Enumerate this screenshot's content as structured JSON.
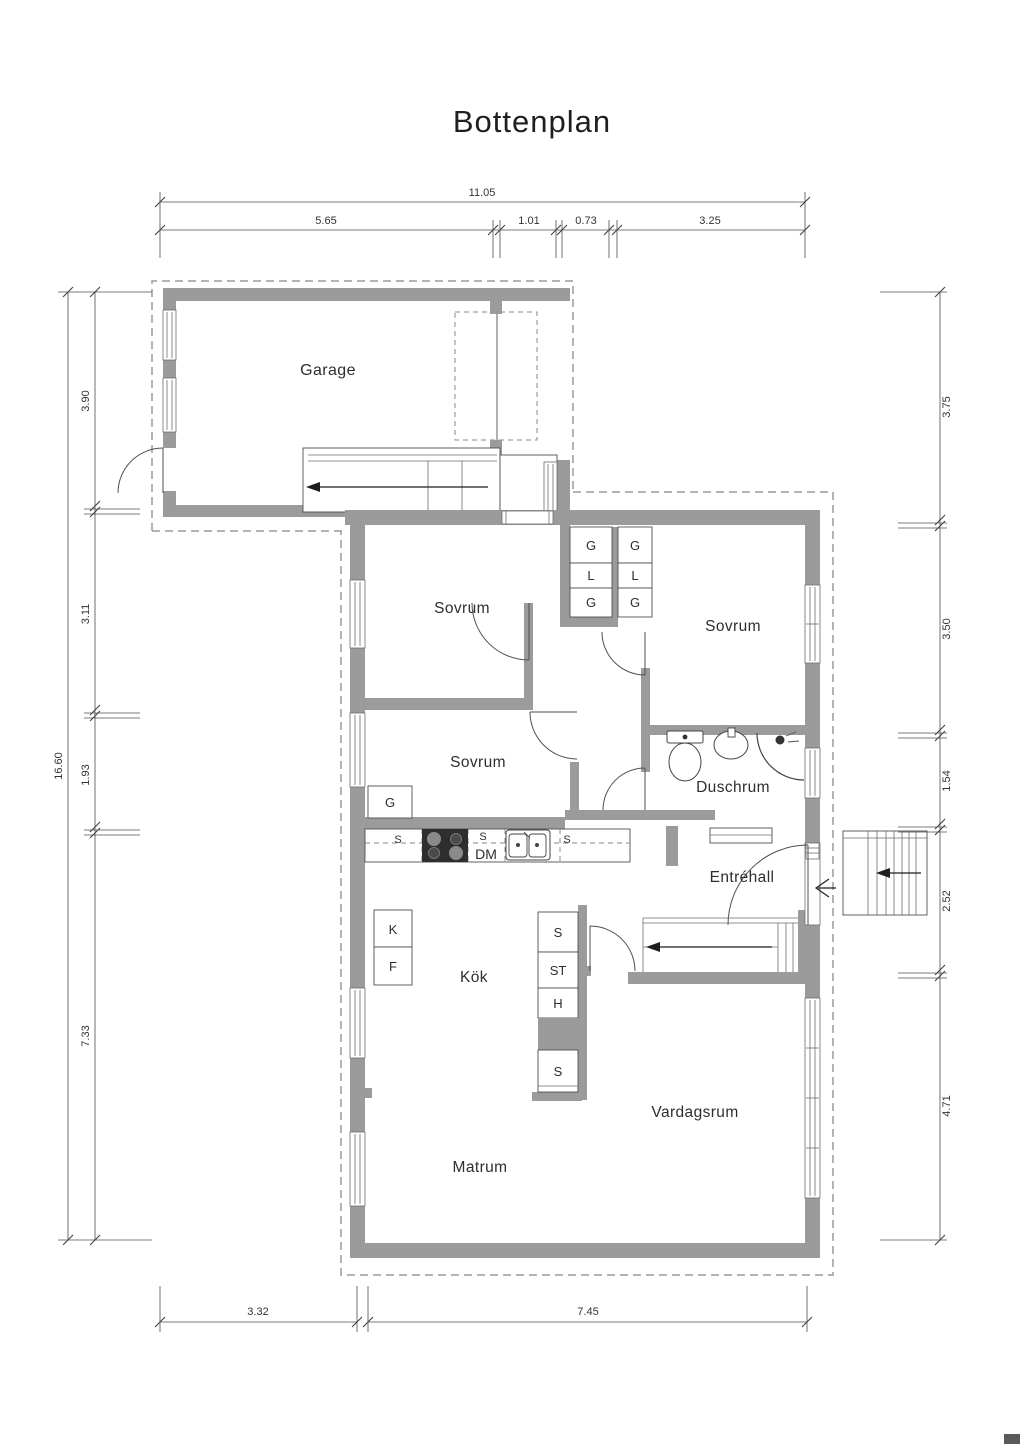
{
  "title": "Bottenplan",
  "rooms": {
    "garage": "Garage",
    "sovrum": "Sovrum",
    "duschrum": "Duschrum",
    "entrehall": "Entréhall",
    "kok": "Kök",
    "vardagsrum": "Vardagsrum",
    "matrum": "Matrum"
  },
  "cabinet_labels": {
    "g": "G",
    "l": "L",
    "s": "S",
    "st": "ST",
    "h": "H",
    "k": "K",
    "f": "F",
    "dm": "DM"
  },
  "dimensions": {
    "top": {
      "total": "11.05",
      "segments": [
        "5.65",
        "1.01",
        "0.73",
        "3.25"
      ]
    },
    "left": {
      "total": "16.60",
      "segments": [
        "3.90",
        "3.11",
        "1.93",
        "7.33"
      ]
    },
    "right": {
      "segments": [
        "3.75",
        "3.50",
        "1.54",
        "2.52",
        "4.71"
      ]
    },
    "bottom": {
      "segments": [
        "3.32",
        "7.45"
      ]
    }
  },
  "colors": {
    "wall": "#9b9b9b",
    "line": "#4f4f4f",
    "dashed_outline": "#9a9a9a",
    "text": "#2e2e2e"
  }
}
